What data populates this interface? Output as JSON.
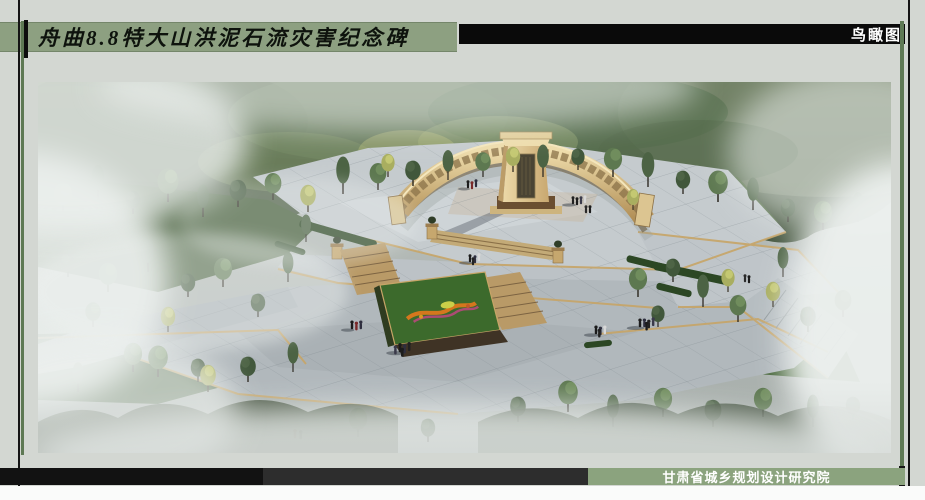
{
  "board": {
    "title": "舟曲8.8特大山洪泥石流灾害纪念碑",
    "view_label": "鸟瞰图",
    "credit": "甘肃省城乡规划设计研究院"
  },
  "colors": {
    "background": "#d3d7d2",
    "title_band_green": "#8da081",
    "top_band_black": "#0a0a0a",
    "credit_band_green": "#8ba37e",
    "credit_band_black": "#121212",
    "credit_band_gray": "#2d2d2d",
    "accent_line_green": "#5e7954",
    "accent_line_black": "#141414",
    "memorial_wall_tan": "#d8c28e",
    "plaza_paving_gray": "#b7bec2",
    "foliage_green": "#4b6140",
    "mist_white": "#edf1ef"
  }
}
